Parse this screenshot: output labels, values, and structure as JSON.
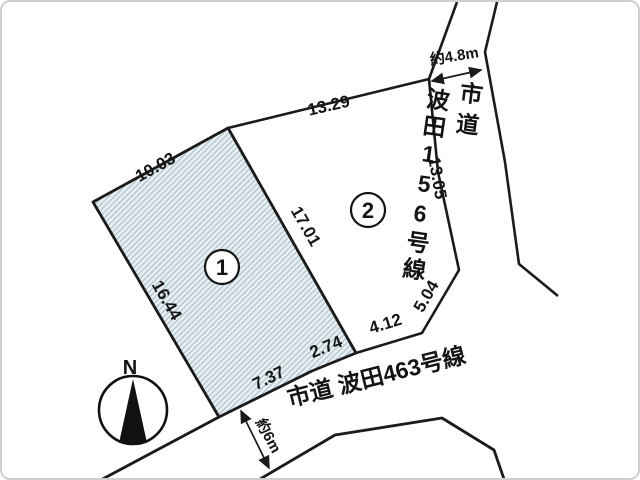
{
  "plots": {
    "plot1": {
      "number": "1",
      "edge_top_left": "10.03",
      "edge_left": "16.44",
      "edge_divider": "17.01",
      "edge_bottom_outer": "7.37",
      "edge_bottom_inner": "2.74"
    },
    "plot2": {
      "number": "2",
      "edge_top": "13.29",
      "edge_right": "13.05",
      "edge_bottom_upper": "5.04",
      "edge_bottom_lower": "4.12"
    }
  },
  "roads": {
    "road_156": {
      "name_column_right": "市道",
      "name_column_left": "波田156号線",
      "width_label": "約4.8m"
    },
    "road_463": {
      "name": "市道 波田463号線",
      "width_label": "約6m"
    }
  },
  "compass": {
    "north_label": "N"
  },
  "colors": {
    "line": "#1b1b1b",
    "hatch_line": "#a9bfca",
    "hatch_bg": "#e8eef1"
  }
}
